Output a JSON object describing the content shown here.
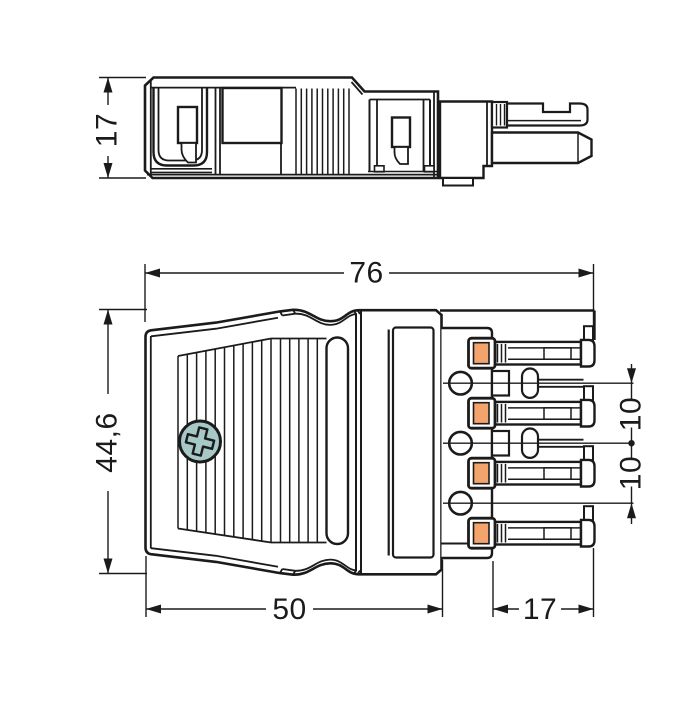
{
  "drawing": {
    "kind": "connector-technical-drawing",
    "colors": {
      "line": "#1b1b1b",
      "fill": "#ffffff",
      "screw_head": "#a6c9c7",
      "clamp_insert": "#f2a46c"
    },
    "side_view": {
      "name": "side-view",
      "dim_height": "17"
    },
    "front_view": {
      "name": "front-view",
      "dim_total_width": "76",
      "dim_total_height": "44,6",
      "dim_body_width": "50",
      "dim_pin_length": "17",
      "dim_pitch_upper": "10",
      "dim_pitch_lower": "10",
      "pole_count": 4,
      "test_port_count": 3,
      "screw_icon": "phillips-screw"
    }
  }
}
